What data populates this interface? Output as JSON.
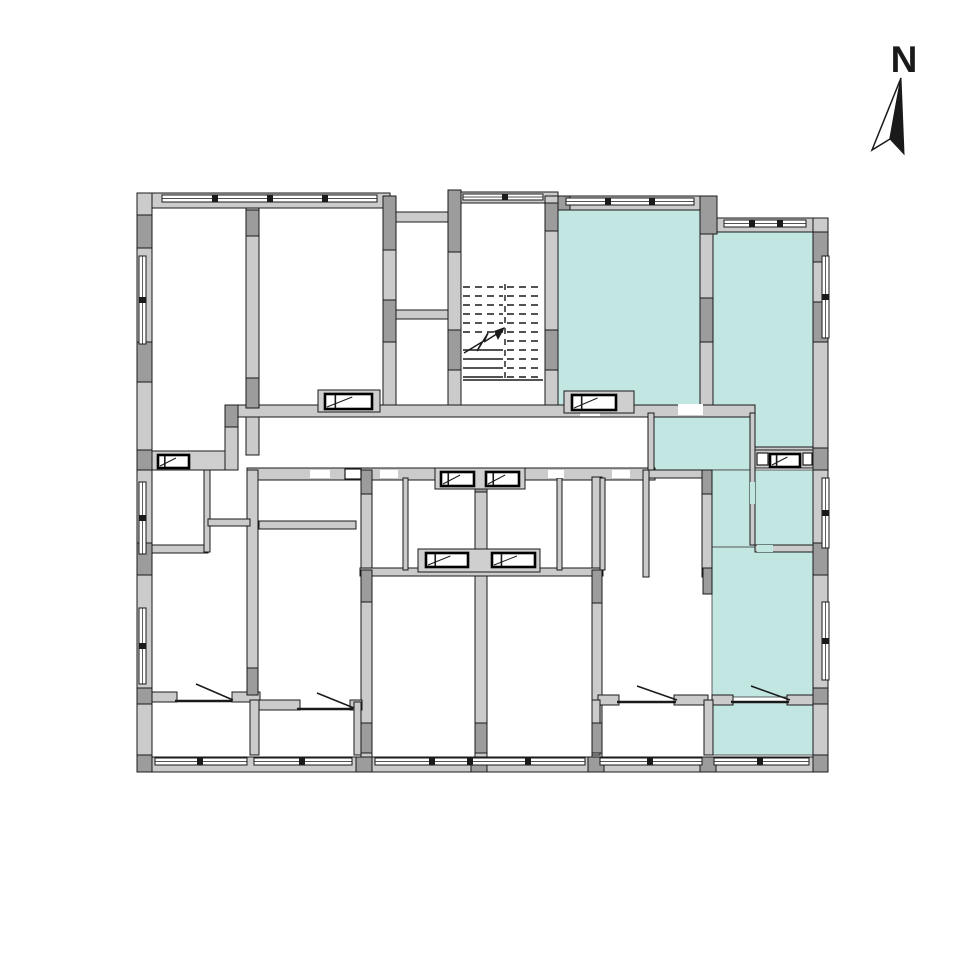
{
  "north": {
    "label": "N",
    "label_x": 904,
    "label_y": 72,
    "label_size": 37,
    "white_half": "901,78 872,150 890,139",
    "black_half": "901,78 890,139 904,154"
  },
  "colors": {
    "highlight": "#c2e6e2",
    "wall": "#cbcbcb",
    "wall_dark": "#9c9c9c",
    "band": "#cfcfcf",
    "line": "#1a1a1a",
    "vent_stroke": "#000000",
    "background": "#ffffff"
  },
  "plan": {
    "teal_rooms": [
      [
        558,
        210,
        142,
        195
      ],
      [
        713,
        232,
        100,
        218
      ],
      [
        648,
        413,
        102,
        57
      ],
      [
        712,
        470,
        43,
        107
      ],
      [
        755,
        470,
        58,
        75
      ],
      [
        712,
        547,
        101,
        150
      ],
      [
        712,
        702,
        101,
        53
      ]
    ],
    "walls": [
      [
        137,
        193,
        253,
        15
      ],
      [
        461,
        192,
        97,
        11
      ],
      [
        545,
        196,
        172,
        14
      ],
      [
        700,
        218,
        128,
        14
      ],
      [
        137,
        193,
        15,
        579
      ],
      [
        813,
        218,
        15,
        554
      ],
      [
        137,
        757,
        691,
        15
      ],
      [
        246,
        208,
        13,
        247
      ],
      [
        383,
        208,
        13,
        207
      ],
      [
        448,
        203,
        13,
        212
      ],
      [
        545,
        203,
        13,
        212
      ],
      [
        700,
        210,
        13,
        205
      ],
      [
        225,
        405,
        13,
        65
      ],
      [
        383,
        212,
        78,
        10
      ],
      [
        396,
        310,
        52,
        9
      ],
      [
        225,
        405,
        530,
        12
      ],
      [
        247,
        468,
        408,
        12
      ],
      [
        643,
        470,
        69,
        8
      ],
      [
        361,
        470,
        11,
        287
      ],
      [
        475,
        468,
        12,
        289
      ],
      [
        592,
        477,
        10,
        280
      ],
      [
        247,
        470,
        11,
        225
      ],
      [
        360,
        568,
        243,
        8
      ],
      [
        140,
        545,
        68,
        8
      ],
      [
        259,
        521,
        97,
        8
      ],
      [
        643,
        470,
        6,
        107
      ],
      [
        702,
        470,
        10,
        107
      ],
      [
        750,
        413,
        5,
        132
      ],
      [
        648,
        413,
        6,
        57
      ],
      [
        755,
        447,
        58,
        6
      ],
      [
        755,
        545,
        58,
        7
      ],
      [
        204,
        470,
        6,
        82
      ],
      [
        208,
        519,
        42,
        7
      ],
      [
        403,
        478,
        5,
        92
      ],
      [
        557,
        478,
        5,
        92
      ],
      [
        600,
        478,
        5,
        92
      ],
      [
        140,
        692,
        37,
        10
      ],
      [
        232,
        692,
        28,
        10
      ],
      [
        258,
        700,
        42,
        10
      ],
      [
        350,
        700,
        12,
        10
      ],
      [
        598,
        695,
        21,
        10
      ],
      [
        674,
        695,
        34,
        10
      ],
      [
        712,
        695,
        21,
        10
      ],
      [
        787,
        695,
        26,
        10
      ],
      [
        250,
        700,
        9,
        55
      ],
      [
        354,
        702,
        7,
        53
      ],
      [
        592,
        700,
        8,
        55
      ],
      [
        704,
        700,
        9,
        55
      ]
    ],
    "piers": [
      [
        137,
        215,
        15,
        33
      ],
      [
        137,
        342,
        15,
        40
      ],
      [
        137,
        450,
        15,
        20
      ],
      [
        137,
        543,
        15,
        32
      ],
      [
        137,
        688,
        15,
        16
      ],
      [
        137,
        755,
        15,
        17
      ],
      [
        383,
        196,
        13,
        54
      ],
      [
        448,
        190,
        13,
        62
      ],
      [
        246,
        210,
        13,
        26
      ],
      [
        246,
        378,
        13,
        30
      ],
      [
        383,
        300,
        13,
        42
      ],
      [
        448,
        330,
        13,
        40
      ],
      [
        545,
        330,
        13,
        40
      ],
      [
        545,
        203,
        13,
        28
      ],
      [
        700,
        196,
        17,
        38
      ],
      [
        700,
        298,
        13,
        44
      ],
      [
        558,
        196,
        12,
        14
      ],
      [
        813,
        232,
        15,
        30
      ],
      [
        813,
        302,
        15,
        40
      ],
      [
        813,
        448,
        15,
        22
      ],
      [
        813,
        543,
        15,
        32
      ],
      [
        813,
        688,
        15,
        16
      ],
      [
        813,
        755,
        15,
        17
      ],
      [
        225,
        405,
        13,
        22
      ],
      [
        361,
        470,
        11,
        24
      ],
      [
        361,
        570,
        11,
        32
      ],
      [
        361,
        723,
        11,
        30
      ],
      [
        475,
        468,
        12,
        24
      ],
      [
        475,
        723,
        12,
        30
      ],
      [
        592,
        570,
        10,
        33
      ],
      [
        592,
        723,
        10,
        30
      ],
      [
        702,
        470,
        10,
        24
      ],
      [
        703,
        568,
        9,
        26
      ],
      [
        247,
        668,
        11,
        27
      ],
      [
        356,
        757,
        16,
        15
      ],
      [
        471,
        757,
        16,
        15
      ],
      [
        588,
        757,
        16,
        15
      ],
      [
        700,
        757,
        16,
        15
      ]
    ],
    "gaps": [
      [
        580,
        406,
        20,
        10,
        "w"
      ],
      [
        678,
        404,
        25,
        11,
        "w"
      ],
      [
        310,
        470,
        20,
        8,
        "w"
      ],
      [
        380,
        470,
        18,
        8,
        "w"
      ],
      [
        548,
        470,
        16,
        8,
        "w"
      ],
      [
        612,
        470,
        18,
        8,
        "w"
      ],
      [
        750,
        482,
        5,
        22,
        "t"
      ],
      [
        757,
        545,
        16,
        7,
        "t"
      ]
    ],
    "vent_bands": [
      [
        318,
        390,
        62,
        22
      ],
      [
        564,
        391,
        70,
        22
      ],
      [
        152,
        451,
        73,
        19
      ],
      [
        755,
        450,
        58,
        18
      ],
      [
        435,
        468,
        90,
        21
      ],
      [
        418,
        549,
        122,
        23
      ]
    ],
    "vent_cells": [
      [
        757,
        453,
        11,
        12
      ],
      [
        803,
        453,
        9,
        12
      ],
      [
        345,
        469,
        16,
        10
      ]
    ],
    "vents": [
      [
        325,
        394,
        47,
        15
      ],
      [
        572,
        395,
        44,
        15
      ],
      [
        158,
        455,
        31,
        13
      ],
      [
        770,
        454,
        30,
        13
      ],
      [
        441,
        472,
        33,
        14
      ],
      [
        486,
        472,
        33,
        14
      ],
      [
        426,
        553,
        42,
        14
      ],
      [
        492,
        553,
        43,
        14
      ]
    ],
    "windows": [
      {
        "r": [
          162,
          195,
          215,
          7
        ],
        "o": "h",
        "ticks": [
          215,
          270,
          325
        ]
      },
      {
        "r": [
          566,
          198,
          128,
          7
        ],
        "o": "h",
        "ticks": [
          608,
          652
        ]
      },
      {
        "r": [
          724,
          220,
          82,
          7
        ],
        "o": "h",
        "ticks": [
          752,
          780
        ]
      },
      {
        "r": [
          463,
          194,
          80,
          6
        ],
        "o": "h",
        "ticks": [
          505
        ]
      },
      {
        "r": [
          155,
          758,
          92,
          7
        ],
        "o": "h",
        "ticks": [
          200
        ]
      },
      {
        "r": [
          254,
          758,
          98,
          7
        ],
        "o": "h",
        "ticks": [
          302
        ]
      },
      {
        "r": [
          375,
          758,
          210,
          7
        ],
        "o": "h",
        "ticks": [
          432,
          470,
          528
        ]
      },
      {
        "r": [
          600,
          758,
          102,
          7
        ],
        "o": "h",
        "ticks": [
          650
        ]
      },
      {
        "r": [
          714,
          758,
          95,
          7
        ],
        "o": "h",
        "ticks": [
          760
        ]
      },
      {
        "r": [
          139,
          256,
          7,
          88
        ],
        "o": "v",
        "ticks": [
          300
        ]
      },
      {
        "r": [
          139,
          482,
          7,
          72
        ],
        "o": "v",
        "ticks": [
          518
        ]
      },
      {
        "r": [
          139,
          608,
          7,
          76
        ],
        "o": "v",
        "ticks": [
          646
        ]
      },
      {
        "r": [
          822,
          256,
          7,
          82
        ],
        "o": "v",
        "ticks": [
          297
        ]
      },
      {
        "r": [
          822,
          478,
          7,
          70
        ],
        "o": "v",
        "ticks": [
          513
        ]
      },
      {
        "r": [
          822,
          602,
          7,
          78
        ],
        "o": "v",
        "ticks": [
          641
        ]
      }
    ],
    "doors": [
      {
        "sill": [
          175,
          701,
          232,
          701
        ],
        "leaf": [
          196,
          684,
          233,
          700
        ]
      },
      {
        "sill": [
          297,
          709,
          353,
          709
        ],
        "leaf": [
          317,
          693,
          354,
          708
        ]
      },
      {
        "sill": [
          617,
          702,
          676,
          702
        ],
        "leaf": [
          637,
          686,
          677,
          700
        ]
      },
      {
        "sill": [
          731,
          702,
          789,
          702
        ],
        "leaf": [
          751,
          686,
          790,
          700
        ]
      }
    ],
    "stairs": {
      "x1": 461,
      "x2": 545,
      "mid": 505,
      "top": 284,
      "bottom": 380,
      "left_dashed": [
        287,
        296,
        305,
        314,
        323,
        332
      ],
      "left_solid": [
        350,
        359,
        368,
        377
      ],
      "right_dashed": [
        287,
        296,
        305,
        314,
        323,
        332,
        341,
        350,
        359,
        368,
        377
      ],
      "arrow_segs": [
        [
          464,
          353,
          482,
          342
        ],
        [
          482,
          342,
          477,
          351
        ],
        [
          477,
          351,
          488,
          333
        ],
        [
          488,
          333,
          484,
          342
        ],
        [
          484,
          342,
          503,
          330
        ]
      ],
      "arrow_head": "505,327 494,331 498,340"
    }
  }
}
